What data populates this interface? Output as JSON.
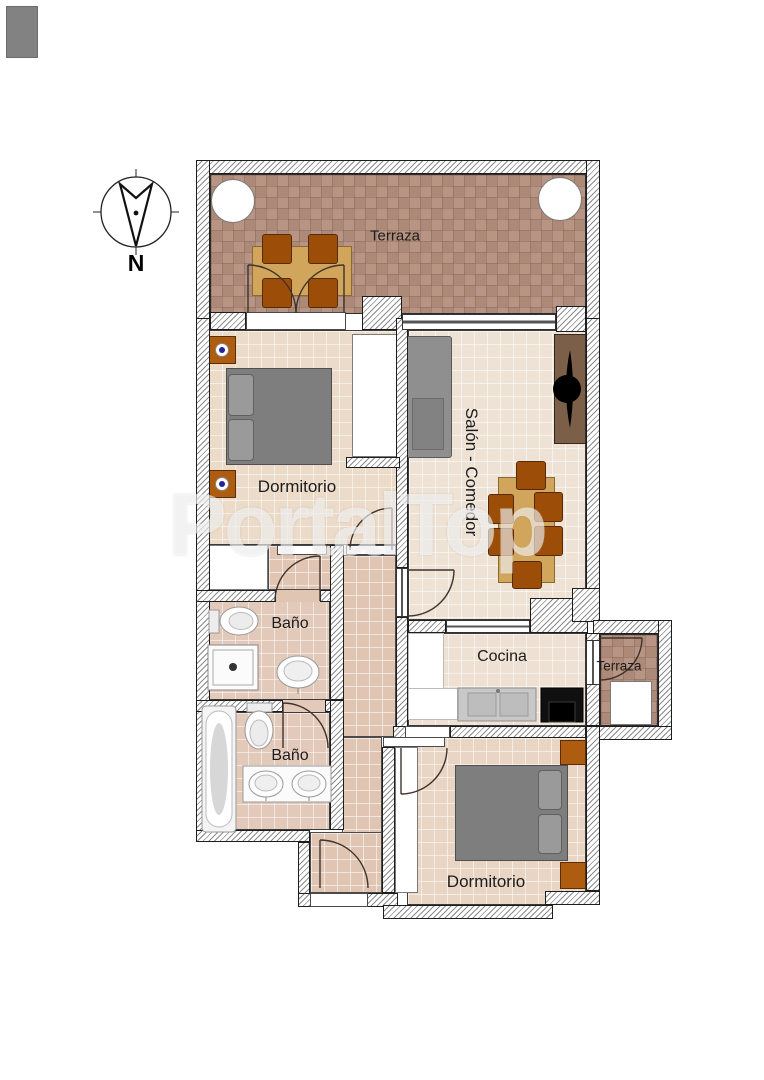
{
  "watermark": {
    "text": "PortalTop"
  },
  "compass": {
    "north_label": "N"
  },
  "rooms": [
    {
      "id": "terraza-top",
      "label": "Terraza"
    },
    {
      "id": "dormitorio-1",
      "label": "Dormitorio"
    },
    {
      "id": "salon-comedor",
      "label": "Salón - Comedor"
    },
    {
      "id": "bano-1",
      "label": "Baño"
    },
    {
      "id": "bano-2",
      "label": "Baño"
    },
    {
      "id": "cocina",
      "label": "Cocina"
    },
    {
      "id": "terraza-right",
      "label": "Terraza"
    },
    {
      "id": "dormitorio-2",
      "label": "Dormitorio"
    }
  ],
  "furniture": {
    "terraza_top": [
      "round-table",
      "round-table",
      "square-table-with-4-chairs",
      "french-double-door"
    ],
    "dormitorio_1": [
      "double-bed",
      "nightstand",
      "nightstand",
      "wardrobe",
      "closet"
    ],
    "salon_comedor": [
      "sofa",
      "tv-cabinet",
      "dining-table-with-6-chairs"
    ],
    "bano_1": [
      "toilet",
      "shower-tray",
      "washbasin"
    ],
    "bano_2": [
      "bathtub",
      "toilet",
      "double-washbasin-vanity"
    ],
    "cocina": [
      "white-counter",
      "sink-unit",
      "stove"
    ],
    "terraza_right": [
      "appliance"
    ],
    "dormitorio_2": [
      "double-bed",
      "nightstand",
      "nightstand",
      "closet"
    ]
  },
  "colors": {
    "wall_hatch": "#8b8b8b",
    "wall_outline": "#1d1d1d",
    "terraza_tile_a": "#ad8a77",
    "terraza_tile_b": "#b79484",
    "floor_beige": "#ecdbc9",
    "floor_cream": "#eee2d5",
    "floor_hall": "#e0c5b3",
    "floor_bath": "#e3c9b9",
    "furniture_orange": "#ad5c10",
    "table_wood": "#d2a55c",
    "chair_wood": "#9c4e08",
    "bed_gray": "#7e7e7e",
    "sofa_gray": "#8f8f8f",
    "tv_cabinet_brown": "#7b5f48",
    "stove_black": "#111111",
    "nightstand_dot_blue": "#23239a",
    "watermark_white": "#ffffff"
  }
}
